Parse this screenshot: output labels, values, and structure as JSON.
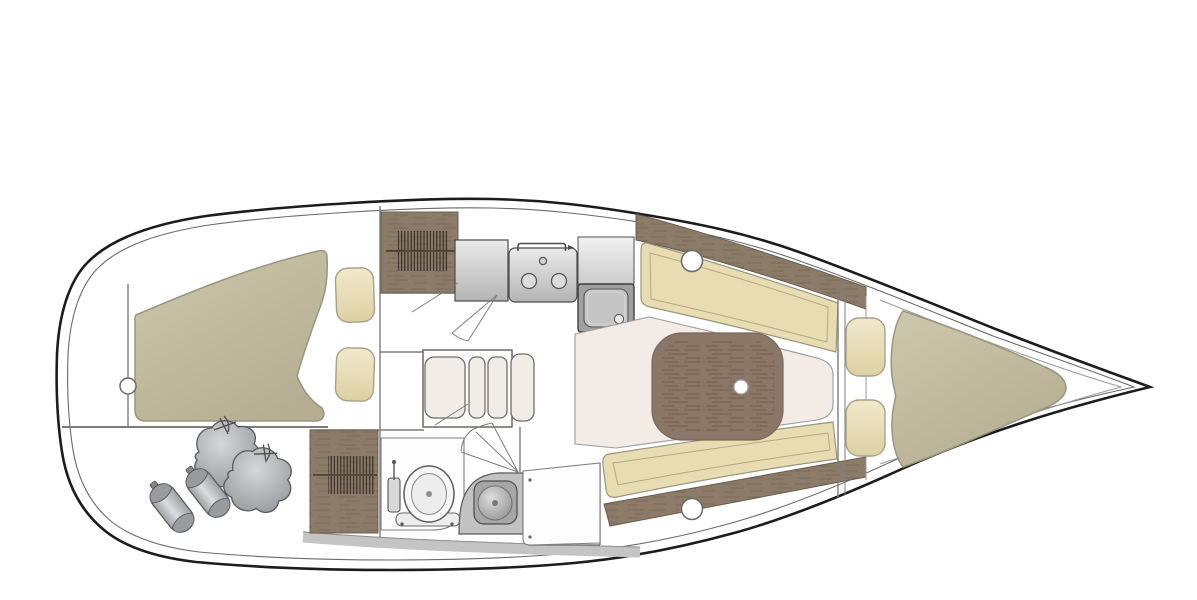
{
  "canvas": {
    "width": 1197,
    "height": 600
  },
  "diagram": {
    "type": "boat-interior-floor-plan",
    "orientation": {
      "bow": "right",
      "stern": "left"
    },
    "palette": {
      "outline": "#1c1c1c",
      "line": "#6a6a6a",
      "wall": "#7d7d7d",
      "deck": "#9a9a9a",
      "berth": "#c6c0a4",
      "berth_dark": "#b5ae92",
      "berth_border": "#99957f",
      "cushion": "#eee5c6",
      "cushion_dark": "#ddd0a4",
      "cushion_border": "#a7a18c",
      "settee": "#e7dcb2",
      "settee_border": "#9a967f",
      "settee_inset": "#b4a97f",
      "wood": "#8d7b69",
      "wood_dark": "#5e5043",
      "wood_border": "#6b5c4d",
      "table_wood": "#8b7667",
      "table_wood_dark": "#6d594b",
      "floor": "#f3ebe6",
      "floor_border": "#9c9c9c",
      "steel_light": "#ebebeb",
      "steel": "#c0c0c0",
      "steel_dark": "#a0a0a0",
      "steel_border": "#4c4c4c",
      "gray_band": "#c4c4c4",
      "fender": "#c6c7c9",
      "fender_dark": "#98999c",
      "fender_border": "#58595c",
      "white": "#ffffff"
    },
    "areas": [
      {
        "name": "aft-cabin",
        "features": [
          "double-berth-olive",
          "pillow",
          "pillow",
          "porthole-circle-on-bulkhead"
        ]
      },
      {
        "name": "aft-storage",
        "features": [
          "sail-bag",
          "sail-bag",
          "fender",
          "fender"
        ]
      },
      {
        "name": "hatched-locker-aft",
        "features": [
          "wood-grain",
          "louver-hatch-symbol"
        ]
      },
      {
        "name": "hatched-locker-head",
        "features": [
          "wood-grain",
          "louver-hatch-symbol"
        ]
      },
      {
        "name": "galley",
        "features": [
          "counter",
          "two-burner-stove-with-handle",
          "square-sink-with-drain"
        ]
      },
      {
        "name": "head",
        "features": [
          "toilet-with-tank-and-base",
          "vanity-counter",
          "round-basin"
        ]
      },
      {
        "name": "salon",
        "features": [
          "folding-leaf-table",
          "wood-saloon-table-with-leg-dot",
          "port-settee",
          "starboard-settee",
          "porthole",
          "porthole",
          "pink-sole"
        ]
      },
      {
        "name": "forward-cabin",
        "features": [
          "v-berth-olive",
          "pillow",
          "pillow",
          "double-bulkhead-lines"
        ]
      }
    ]
  }
}
